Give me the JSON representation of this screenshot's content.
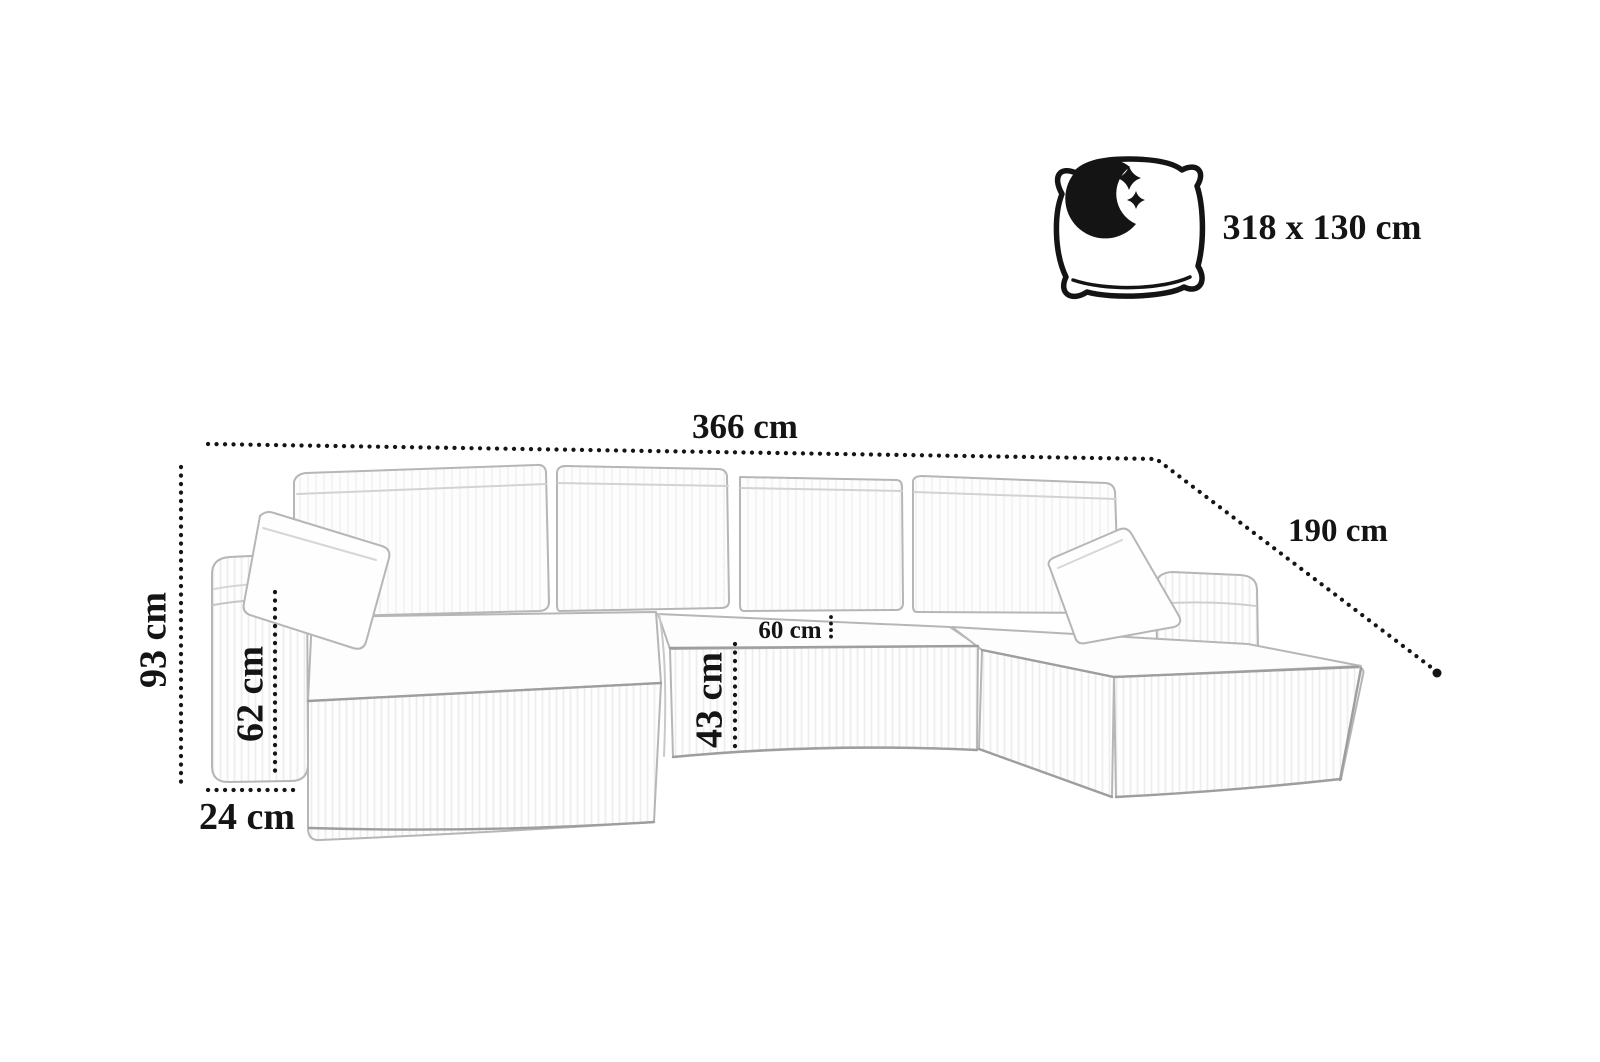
{
  "diagram": {
    "type": "sofa-dimension-diagram",
    "unit": "cm",
    "dimensions": {
      "total_width": {
        "label": "366 cm",
        "value": 366
      },
      "depth": {
        "label": "190 cm",
        "value": 190
      },
      "height": {
        "label": "93 cm",
        "value": 93
      },
      "armrest_height": {
        "label": "62 cm",
        "value": 62
      },
      "armrest_depth": {
        "label": "24 cm",
        "value": 24
      },
      "seat_depth": {
        "label": "60 cm",
        "value": 60
      },
      "seat_height": {
        "label": "43 cm",
        "value": 43
      }
    },
    "sleeping_area": {
      "label": "318 x 130 cm",
      "width_cm": 318,
      "depth_cm": 130,
      "icon": "moon-pillow-icon"
    },
    "colors": {
      "dimension_line": "#151515",
      "label_text": "#141414",
      "sketch_stroke": "#b6b6b6",
      "background": "#ffffff"
    }
  }
}
